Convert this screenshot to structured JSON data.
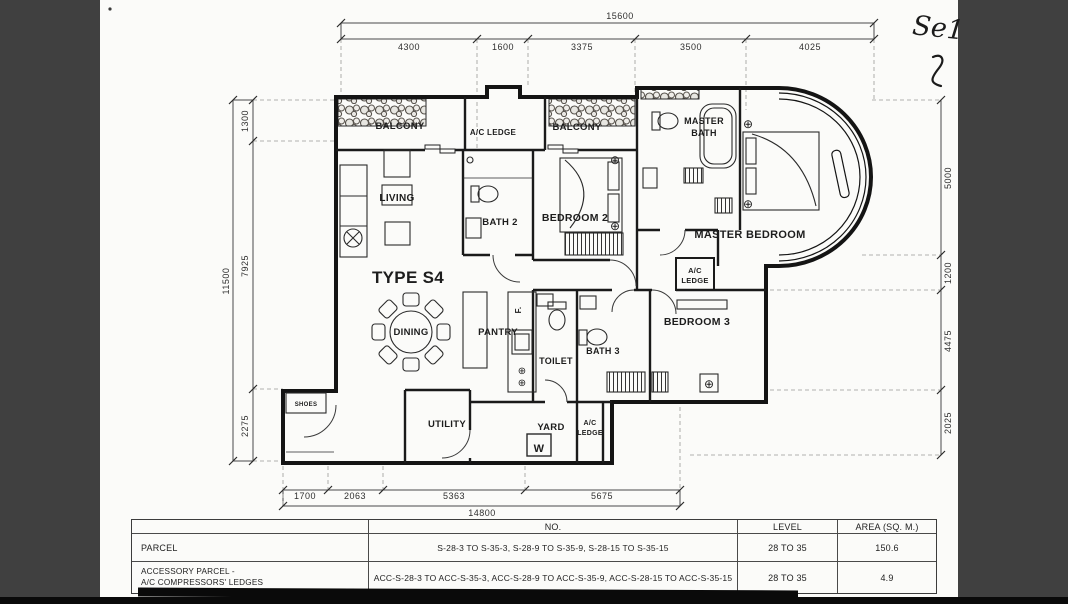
{
  "colors": {
    "surround": "#404040",
    "paper": "#fbfbf9",
    "ink": "#1d1d1d"
  },
  "annotations": {
    "handwritten_note": "Se1"
  },
  "title": {
    "unit_type": "TYPE S4"
  },
  "rooms": {
    "balcony_left": "BALCONY",
    "ac_ledge_top": "A/C LEDGE",
    "balcony_right": "BALCONY",
    "master_bath": [
      "MASTER",
      "BATH"
    ],
    "living": "LIVING",
    "bath2": "BATH 2",
    "bedroom2": "BEDROOM 2",
    "master_bedroom": "MASTER BEDROOM",
    "ac_ledge_mid": [
      "A/C",
      "LEDGE"
    ],
    "dining": "DINING",
    "pantry": "PANTRY",
    "fridge": "F.",
    "toilet": "TOILET",
    "bath3": "BATH 3",
    "bedroom3": "BEDROOM 3",
    "shoes": "SHOES",
    "utility": "UTILITY",
    "yard": "YARD",
    "washer": "W",
    "ac_ledge_bottom": [
      "A/C",
      "LEDGE"
    ]
  },
  "dimensions": {
    "top": {
      "total": "15600",
      "segments": [
        "4300",
        "1600",
        "3375",
        "3500",
        "4025"
      ]
    },
    "left": {
      "total": "11500",
      "segments": [
        "1300",
        "7925",
        "2275"
      ]
    },
    "right": {
      "segments": [
        "5000",
        "1200",
        "4475",
        "2025"
      ]
    },
    "bottom": {
      "total": "14800",
      "segments": [
        "1700",
        "2063",
        "5363",
        "5675"
      ]
    }
  },
  "table": {
    "headers": {
      "no": "NO.",
      "level": "LEVEL",
      "area": "AREA (SQ. M.)"
    },
    "rows": [
      {
        "label": "PARCEL",
        "no": "S-28-3  TO  S-35-3,  S-28-9 TO  S-35-9,  S-28-15 TO S-35-15",
        "level": "28 TO 35",
        "area": "150.6"
      },
      {
        "label_line1": "ACCESSORY PARCEL -",
        "label_line2": "A/C COMPRESSORS' LEDGES",
        "no": "ACC-S-28-3  TO  ACC-S-35-3,  ACC-S-28-9 TO  ACC-S-35-9,  ACC-S-28-15 TO ACC-S-35-15",
        "level": "28 TO 35",
        "area": "4.9"
      }
    ]
  }
}
